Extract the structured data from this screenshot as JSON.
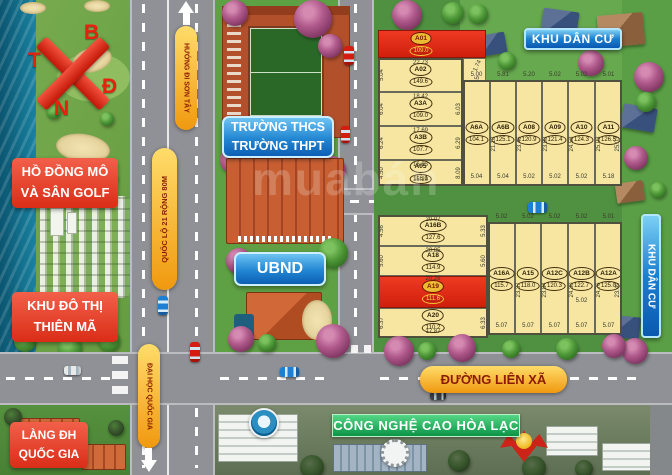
{
  "compass": {
    "north": "B",
    "west": "T",
    "east": "Đ",
    "south": "N"
  },
  "areas": {
    "lake_golf": {
      "line1": "HỒ ĐỒNG MÔ",
      "line2": "VÀ SÂN GOLF"
    },
    "thien_ma": {
      "line1": "KHU ĐÔ THỊ",
      "line2": "THIÊN MÃ"
    },
    "school": {
      "line1": "TRƯỜNG THCS",
      "line2": "TRƯỜNG THPT"
    },
    "ubnd": "UBND",
    "kdc_top": "KHU DÂN CƯ",
    "kdc_right": "KHU DÂN CƯ",
    "lang_dh": {
      "line1": "LÀNG ĐH",
      "line2": "QUỐC GIA"
    },
    "hoa_lac": "CÔNG NGHỆ CAO HÒA LẠC"
  },
  "roads": {
    "son_tay": "HƯỚNG ĐI SƠN TÂY",
    "ql21": "QUỐC LỘ 21 RỘNG 80M",
    "lien_xa": "ĐƯỜNG LIÊN XÃ",
    "dai_hoc": "ĐẠI HỌC QUỐC GIA"
  },
  "watermark": "muabán",
  "colors": {
    "plot_fill": "#f6e6a2",
    "plot_red": "#e02c18",
    "label_red": "#e8462e",
    "label_blue": "#1069c0",
    "pill_orange": "#f2a61c",
    "banner_green": "#0c9446"
  },
  "plots": {
    "upper_left": [
      {
        "id": "A01",
        "area": "109.0"
      },
      {
        "id": "A02",
        "area": "149.6",
        "top": "22.73",
        "left": "5.04"
      },
      {
        "id": "A3A",
        "area": "109.0",
        "top": "18.42",
        "left": "6.04",
        "right": "6.03"
      },
      {
        "id": "A3B",
        "area": "107.7",
        "top": "17.69",
        "left": "6.24",
        "right": "6.29"
      },
      {
        "id": "A05",
        "area": "116.1",
        "top": "16.83",
        "left": "4.50",
        "right": "8.09",
        "bottom": "15.20"
      }
    ],
    "upper_extra_dims": [
      "1.74",
      "3.55"
    ],
    "upper_right": [
      {
        "id": "A6A",
        "area": "104.1",
        "top": "5.00",
        "bottom": "5.04"
      },
      {
        "id": "A6B",
        "area": "125.1",
        "top": "5.81",
        "bottom": "5.04",
        "side": "21.18"
      },
      {
        "id": "A08",
        "area": "120.9",
        "top": "5.20",
        "bottom": "5.02",
        "side": "23.46"
      },
      {
        "id": "A09",
        "area": "121.4",
        "top": "5.02",
        "bottom": "5.02",
        "side": "23.98"
      },
      {
        "id": "A10",
        "area": "124.3",
        "top": "5.02",
        "bottom": "5.02",
        "side": "24.58"
      },
      {
        "id": "A11",
        "area": "126.5",
        "top": "5.01",
        "bottom": "5.18",
        "side": "25.03",
        "side2": "25.03"
      }
    ],
    "lower_left": [
      {
        "id": "A16B",
        "area": "127.6",
        "top": "20.07",
        "left": "4.56",
        "right": "5.33"
      },
      {
        "id": "A18",
        "area": "114.9",
        "top": "20.85",
        "left": "5.60",
        "right": "5.60"
      },
      {
        "id": "A19",
        "area": "111.6",
        "top": "20.29"
      },
      {
        "id": "A20",
        "area": "110.2",
        "left": "6.37",
        "right": "6.33",
        "bottom": "17.87"
      }
    ],
    "lower_right": [
      {
        "id": "A16A",
        "area": "115.7",
        "top": "5.02",
        "bottom": "5.07"
      },
      {
        "id": "A15",
        "area": "118.0",
        "top": "5.02",
        "bottom": "5.07",
        "side": "23.37"
      },
      {
        "id": "A12C",
        "area": "120.3",
        "top": "5.02",
        "bottom": "5.07",
        "side": "23.84"
      },
      {
        "id": "A12B",
        "area": "122.7",
        "top": "5.02",
        "bottom": "5.07",
        "side": "24.30",
        "extra": "5.02"
      },
      {
        "id": "A12A",
        "area": "125.0",
        "top": "5.01",
        "bottom": "5.07",
        "side": "24.76",
        "side2": "23.49"
      }
    ]
  }
}
